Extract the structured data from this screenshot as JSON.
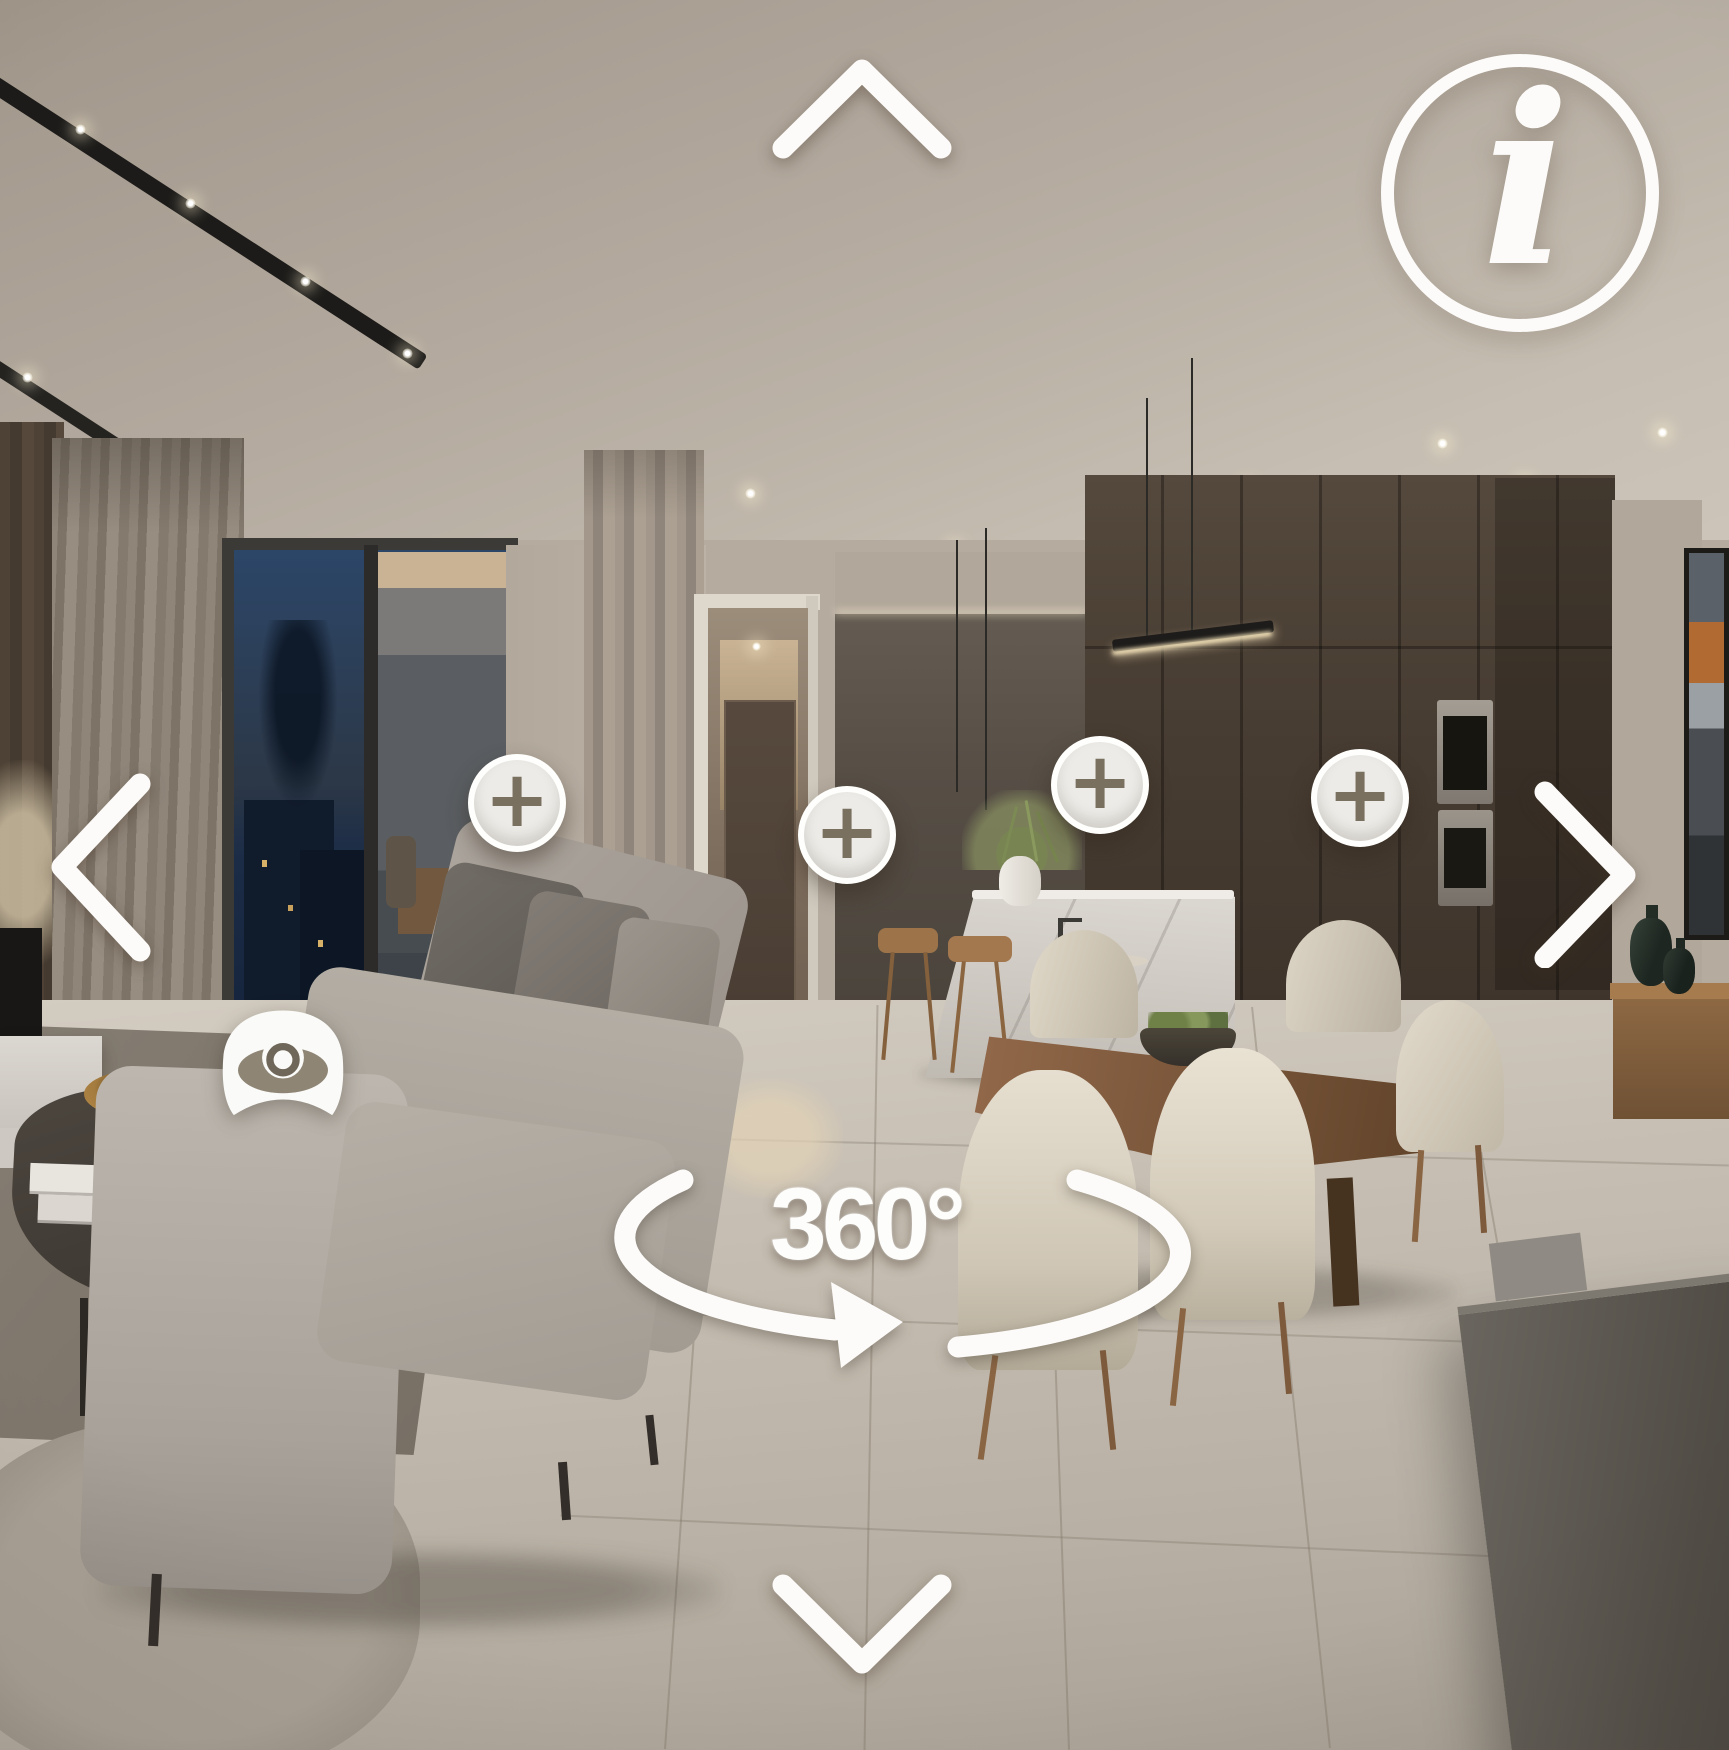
{
  "hud": {
    "rotation_label": "360°",
    "info_glyph": "i",
    "hotspot_count": 4,
    "hotspots": [
      {
        "glyph": "+",
        "x": 468,
        "y": 754
      },
      {
        "glyph": "+",
        "x": 798,
        "y": 786
      },
      {
        "glyph": "+",
        "x": 1051,
        "y": 736
      },
      {
        "glyph": "+",
        "x": 1311,
        "y": 749
      }
    ],
    "icons": {
      "up": "chevron-up-icon",
      "down": "chevron-down-icon",
      "left": "chevron-left-icon",
      "right": "chevron-right-icon",
      "info": "info-icon",
      "hotspot": "plus-icon",
      "viewpoint": "eye-icon",
      "rotation": "rotate-arrow-icon"
    },
    "colors": {
      "overlay_white": "#fcfbf9",
      "hotspot_fill": "#ecebe7",
      "hotspot_glyph": "#7a7060"
    }
  }
}
